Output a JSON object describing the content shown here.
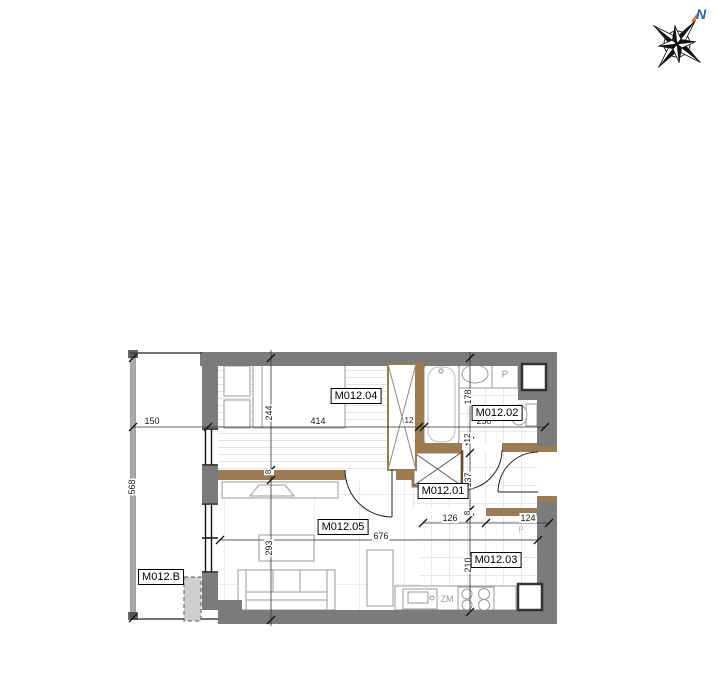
{
  "drawing": {
    "type": "apartment-floor-plan",
    "compass": {
      "north_label": "N"
    },
    "rooms": {
      "bedroom": {
        "label": "M012.04"
      },
      "bathroom": {
        "label": "M012.02"
      },
      "hall": {
        "label": "M012.01"
      },
      "living": {
        "label": "M012.05"
      },
      "kitchen": {
        "label": "M012.03"
      },
      "balcony": {
        "label": "M012.B"
      }
    },
    "fixtures": {
      "kitchen_sink": "ZM",
      "washing_machine": "P",
      "kitchen_faint_mark": "P"
    },
    "dimensions": {
      "balcony_width": "150",
      "bedroom_width": "414",
      "wall_top_a": "12",
      "bathroom_width": "250",
      "balcony_height": "568",
      "bedroom_depth": "244",
      "wall_mid_a": "8",
      "living_depth": "293",
      "bathroom_depth": "178",
      "wall_mid_b": "12",
      "hall_depth": "137",
      "wall_mid_c": "8",
      "kitchen_depth": "210",
      "kitchen_seg_left": "126",
      "kitchen_seg_right": "124",
      "living_width": "676"
    },
    "colors": {
      "wall_gray": "#7b7b7b",
      "wood_wall_brown": "#9b7b52",
      "dimension_black": "#1a1a1a",
      "floor_line": "#e6e6e6",
      "north_blue": "#1f63b0",
      "north_orange": "#e07b28"
    }
  }
}
